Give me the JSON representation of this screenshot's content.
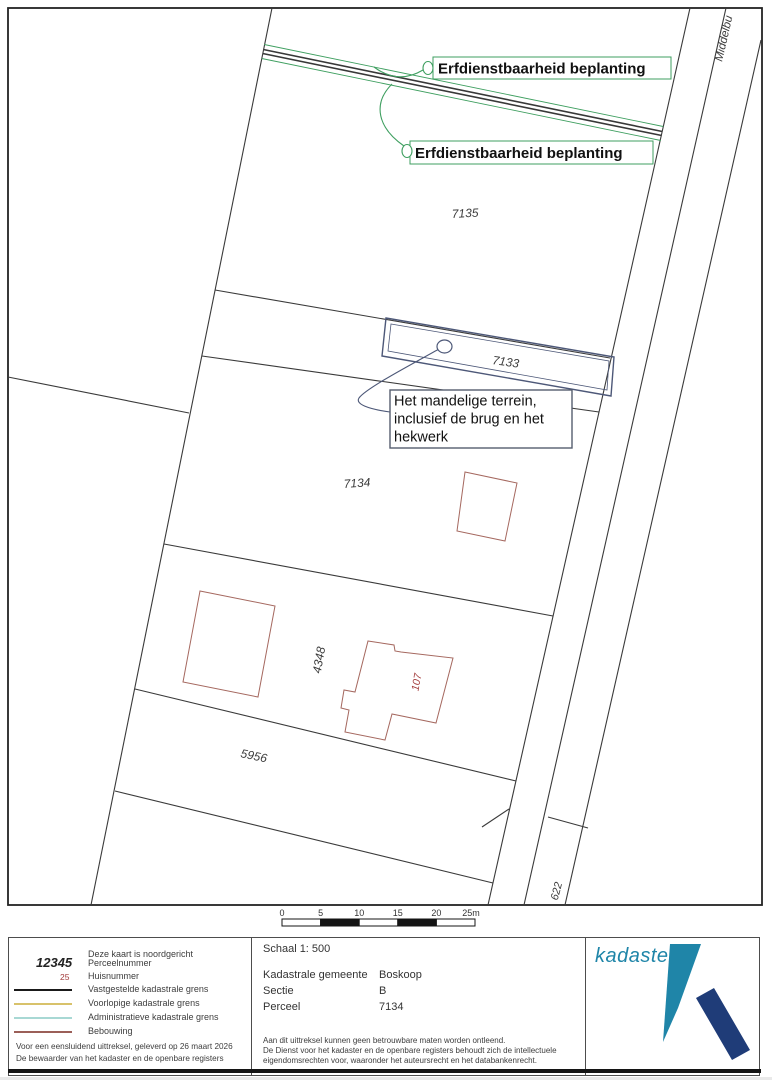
{
  "map": {
    "road_name": "Middelbu",
    "labels": {
      "p7135": "7135",
      "p7133": "7133",
      "p7134": "7134",
      "p4348": "4348",
      "p5956": "5956",
      "p622": "622",
      "house107": "107"
    },
    "annotations": {
      "servitude_top": "Erfdienstbaarheid beplanting",
      "servitude_bottom": "Erfdienstbaarheid beplanting",
      "mandelig_line1": "Het mandelige terrein,",
      "mandelig_line2": "inclusief de brug en het",
      "mandelig_line3": "hekwerk"
    },
    "scalebar": {
      "ticks": [
        "0",
        "5",
        "10",
        "15",
        "20",
        "25m"
      ]
    }
  },
  "legend": {
    "north_note": "Deze kaart is noordgericht",
    "items": [
      {
        "swatch": "12345",
        "label": "Perceelnummer"
      },
      {
        "swatch": "25",
        "label": "Huisnummer"
      },
      {
        "swatch": "line-black",
        "label": "Vastgestelde kadastrale grens"
      },
      {
        "swatch": "line-yellow",
        "label": "Voorlopige kadastrale grens"
      },
      {
        "swatch": "line-cyan",
        "label": "Administratieve kadastrale grens"
      },
      {
        "swatch": "line-red",
        "label": "Bebouwing"
      }
    ],
    "certification1": "Voor een eensluidend uittreksel, geleverd op 26 maart 2026",
    "certification2": "De bewaarder van het kadaster en de openbare registers"
  },
  "info": {
    "schaal": "Schaal 1: 500",
    "fields": [
      {
        "label": "Kadastrale gemeente",
        "value": "Boskoop"
      },
      {
        "label": "Sectie",
        "value": "B"
      },
      {
        "label": "Perceel",
        "value": "7134"
      }
    ],
    "disclaimer1": "Aan dit uittreksel kunnen geen betrouwbare maten worden ontleend.",
    "disclaimer2": "De Dienst voor het kadaster en de openbare registers behoudt zich de intellectuele",
    "disclaimer3": "eigendomsrechten voor, waaronder het auteursrecht en het databankenrecht.",
    "logo_wordmark": "kadaster"
  },
  "colors": {
    "boundary_line": "#3a3a3a",
    "servitude_green": "#3f9f60",
    "mandelig_blue": "#4d5878",
    "building_red": "#a5685f",
    "house_number_red": "#a33c3c",
    "legend_voorlopig_yellow": "#d8c26b",
    "legend_administratief_cyan": "#a8d8d4",
    "legend_bebouwing_red": "#9b5f58",
    "logo_teal": "#1f85a8",
    "logo_navy": "#1f3c78"
  }
}
